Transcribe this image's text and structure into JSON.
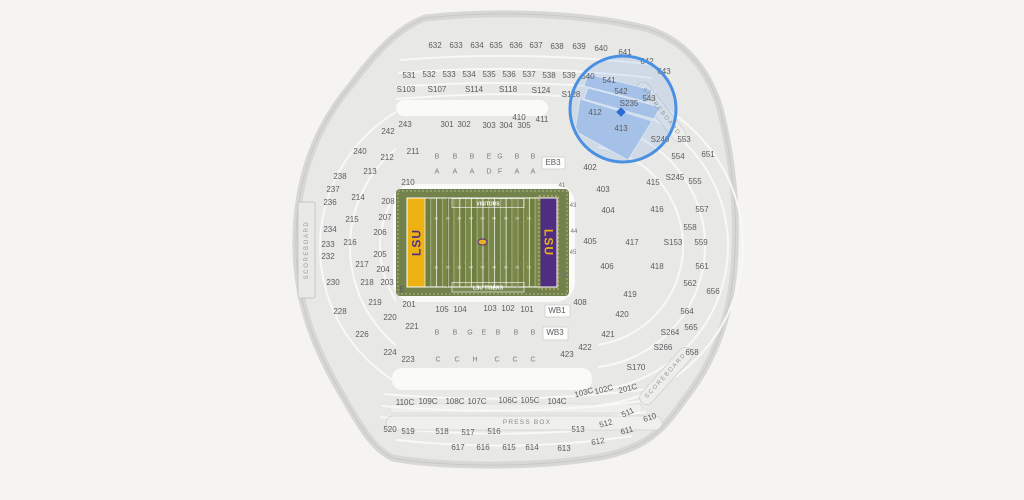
{
  "canvas": {
    "width": 1024,
    "height": 500
  },
  "colors": {
    "background": "#f5f4f2",
    "stands": "#e8e8e7",
    "stand_edge": "#c8c8c7",
    "field_green": "#73824a",
    "stripe_dark": "#6f7e41",
    "stripe_light": "#798847",
    "endzone_gold": "#edb211",
    "endzone_purple": "#4f2d81",
    "highlight_blue": "#4a90e2",
    "marker_blue": "#2b6cd4",
    "label_text": "#5e5e5e"
  },
  "field": {
    "visitors_label": "VISITORS",
    "home_label": "LSU TIGERS",
    "endzone_left_text": "LSU",
    "endzone_right_text": "LSU",
    "yard_numbers": [
      "10",
      "20",
      "30",
      "40",
      "50",
      "40",
      "30",
      "20",
      "10"
    ]
  },
  "selection": {
    "circle": {
      "cx": 623,
      "cy": 109,
      "r": 53
    },
    "marker": {
      "x": 621,
      "y": 112
    },
    "highlighted_sections": [
      "542",
      "543",
      "S235",
      "412",
      "413"
    ]
  },
  "map": {
    "labels": [
      [
        "632",
        435,
        46
      ],
      [
        "633",
        456,
        46
      ],
      [
        "634",
        477,
        46
      ],
      [
        "635",
        496,
        46
      ],
      [
        "636",
        516,
        46
      ],
      [
        "637",
        536,
        46
      ],
      [
        "638",
        557,
        47
      ],
      [
        "639",
        579,
        47
      ],
      [
        "640",
        601,
        49
      ],
      [
        "641",
        625,
        53
      ],
      [
        "642",
        647,
        62
      ],
      [
        "643",
        664,
        72
      ],
      [
        "531",
        409,
        76
      ],
      [
        "532",
        429,
        75
      ],
      [
        "533",
        449,
        75
      ],
      [
        "534",
        469,
        75
      ],
      [
        "535",
        489,
        75
      ],
      [
        "536",
        509,
        75
      ],
      [
        "537",
        529,
        75
      ],
      [
        "538",
        549,
        76
      ],
      [
        "539",
        569,
        76
      ],
      [
        "540",
        588,
        77
      ],
      [
        "541",
        609,
        81
      ],
      [
        "542",
        621,
        92
      ],
      [
        "543",
        649,
        99
      ],
      [
        "S103",
        406,
        90
      ],
      [
        "S107",
        437,
        90
      ],
      [
        "S114",
        474,
        90
      ],
      [
        "S118",
        508,
        90
      ],
      [
        "S124",
        541,
        91
      ],
      [
        "S128",
        571,
        95
      ],
      [
        "410",
        519,
        118
      ],
      [
        "411",
        542,
        120
      ],
      [
        "412",
        595,
        113
      ],
      [
        "413",
        621,
        129
      ],
      [
        "S235",
        629,
        104
      ],
      [
        "243",
        405,
        125
      ],
      [
        "301",
        447,
        125
      ],
      [
        "302",
        464,
        125
      ],
      [
        "303",
        489,
        126
      ],
      [
        "304",
        506,
        126
      ],
      [
        "305",
        524,
        126
      ],
      [
        "EB3",
        553,
        163
      ],
      [
        "242",
        388,
        132
      ],
      [
        "240",
        360,
        152
      ],
      [
        "211",
        413,
        152
      ],
      [
        "212",
        387,
        158
      ],
      [
        "238",
        340,
        177
      ],
      [
        "213",
        370,
        172
      ],
      [
        "210",
        408,
        183
      ],
      [
        "237",
        333,
        190
      ],
      [
        "214",
        358,
        198
      ],
      [
        "208",
        388,
        202
      ],
      [
        "236",
        330,
        203
      ],
      [
        "215",
        352,
        220
      ],
      [
        "207",
        385,
        218
      ],
      [
        "234",
        330,
        230
      ],
      [
        "206",
        380,
        233
      ],
      [
        "233",
        328,
        245
      ],
      [
        "216",
        350,
        243
      ],
      [
        "232",
        328,
        257
      ],
      [
        "205",
        380,
        255
      ],
      [
        "217",
        362,
        265
      ],
      [
        "204",
        383,
        270
      ],
      [
        "230",
        333,
        283
      ],
      [
        "218",
        367,
        283
      ],
      [
        "203",
        387,
        283
      ],
      [
        "E",
        402,
        290
      ],
      [
        "219",
        375,
        303
      ],
      [
        "228",
        340,
        312
      ],
      [
        "201",
        409,
        305
      ],
      [
        "220",
        390,
        318
      ],
      [
        "221",
        412,
        327
      ],
      [
        "226",
        362,
        335
      ],
      [
        "224",
        390,
        353
      ],
      [
        "223",
        408,
        360
      ],
      [
        "105",
        442,
        310
      ],
      [
        "104",
        460,
        310
      ],
      [
        "103",
        490,
        309
      ],
      [
        "102",
        508,
        309
      ],
      [
        "101",
        527,
        310
      ],
      [
        "WB1",
        557,
        311
      ],
      [
        "WB3",
        555,
        333
      ],
      [
        "402",
        590,
        168
      ],
      [
        "403",
        603,
        190
      ],
      [
        "404",
        608,
        211
      ],
      [
        "405",
        590,
        242
      ],
      [
        "406",
        607,
        267
      ],
      [
        "408",
        580,
        303
      ],
      [
        "415",
        653,
        183
      ],
      [
        "416",
        657,
        210
      ],
      [
        "417",
        632,
        243
      ],
      [
        "418",
        657,
        267
      ],
      [
        "419",
        630,
        295
      ],
      [
        "420",
        622,
        315
      ],
      [
        "421",
        608,
        335
      ],
      [
        "422",
        585,
        348
      ],
      [
        "423",
        567,
        355
      ],
      [
        "S240",
        660,
        140
      ],
      [
        "S245",
        675,
        178
      ],
      [
        "S153",
        673,
        243
      ],
      [
        "553",
        684,
        140
      ],
      [
        "554",
        678,
        157
      ],
      [
        "555",
        695,
        182
      ],
      [
        "557",
        702,
        210
      ],
      [
        "558",
        690,
        228
      ],
      [
        "559",
        701,
        243
      ],
      [
        "561",
        702,
        267
      ],
      [
        "562",
        690,
        284
      ],
      [
        "564",
        687,
        312
      ],
      [
        "565",
        691,
        328
      ],
      [
        "651",
        708,
        155
      ],
      [
        "656",
        713,
        292
      ],
      [
        "658",
        692,
        353
      ],
      [
        "S264",
        670,
        333
      ],
      [
        "S266",
        663,
        348
      ],
      [
        "S170",
        636,
        368
      ],
      [
        "110C",
        405,
        403
      ],
      [
        "109C",
        428,
        402
      ],
      [
        "108C",
        455,
        402
      ],
      [
        "107C",
        477,
        402
      ],
      [
        "106C",
        508,
        401
      ],
      [
        "105C",
        530,
        401
      ],
      [
        "104C",
        557,
        402
      ],
      [
        "103C",
        584,
        393,
        "sec",
        -15
      ],
      [
        "102C",
        604,
        390,
        "sec",
        -15
      ],
      [
        "201C",
        628,
        389,
        "sec",
        -15
      ],
      [
        "520",
        390,
        430
      ],
      [
        "519",
        408,
        432
      ],
      [
        "518",
        442,
        432
      ],
      [
        "517",
        468,
        433
      ],
      [
        "516",
        494,
        432
      ],
      [
        "513",
        578,
        430
      ],
      [
        "512",
        606,
        424,
        "sec",
        -15
      ],
      [
        "511",
        628,
        413,
        "sec",
        -25
      ],
      [
        "610",
        650,
        418,
        "sec",
        -20
      ],
      [
        "611",
        627,
        431,
        "sec",
        -15
      ],
      [
        "612",
        598,
        442,
        "sec",
        -10
      ],
      [
        "613",
        564,
        449
      ],
      [
        "614",
        532,
        448
      ],
      [
        "615",
        509,
        448
      ],
      [
        "616",
        483,
        448
      ],
      [
        "617",
        458,
        448
      ],
      [
        "B",
        437,
        157,
        "ltr"
      ],
      [
        "B",
        455,
        157,
        "ltr"
      ],
      [
        "B",
        472,
        157,
        "ltr"
      ],
      [
        "E",
        489,
        157,
        "ltr"
      ],
      [
        "G",
        500,
        157,
        "ltr"
      ],
      [
        "B",
        517,
        157,
        "ltr"
      ],
      [
        "B",
        533,
        157,
        "ltr"
      ],
      [
        "A",
        437,
        172,
        "ltr"
      ],
      [
        "A",
        455,
        172,
        "ltr"
      ],
      [
        "A",
        472,
        172,
        "ltr"
      ],
      [
        "D",
        489,
        172,
        "ltr"
      ],
      [
        "F",
        500,
        172,
        "ltr"
      ],
      [
        "A",
        517,
        172,
        "ltr"
      ],
      [
        "A",
        533,
        172,
        "ltr"
      ],
      [
        "B",
        437,
        333,
        "ltr"
      ],
      [
        "B",
        455,
        333,
        "ltr"
      ],
      [
        "G",
        470,
        333,
        "ltr"
      ],
      [
        "E",
        484,
        333,
        "ltr"
      ],
      [
        "B",
        498,
        333,
        "ltr"
      ],
      [
        "B",
        516,
        333,
        "ltr"
      ],
      [
        "B",
        533,
        333,
        "ltr"
      ],
      [
        "C",
        438,
        360,
        "ltr"
      ],
      [
        "C",
        457,
        360,
        "ltr"
      ],
      [
        "H",
        475,
        360,
        "ltr"
      ],
      [
        "C",
        497,
        360,
        "ltr"
      ],
      [
        "C",
        515,
        360,
        "ltr"
      ],
      [
        "C",
        533,
        360,
        "ltr"
      ],
      [
        "41",
        562,
        186,
        "por"
      ],
      [
        "43",
        573,
        206,
        "por"
      ],
      [
        "44",
        574,
        232,
        "por"
      ],
      [
        "45",
        573,
        253,
        "por"
      ],
      [
        "46",
        564,
        276,
        "por"
      ],
      [
        "SCOREBOARD",
        307,
        250,
        "sb",
        -90
      ],
      [
        "SCOREBOARD",
        661,
        112,
        "sb",
        52
      ],
      [
        "SCOREBOARD",
        666,
        376,
        "sb",
        -48
      ],
      [
        "PRESS BOX",
        527,
        423,
        "pb"
      ]
    ]
  }
}
